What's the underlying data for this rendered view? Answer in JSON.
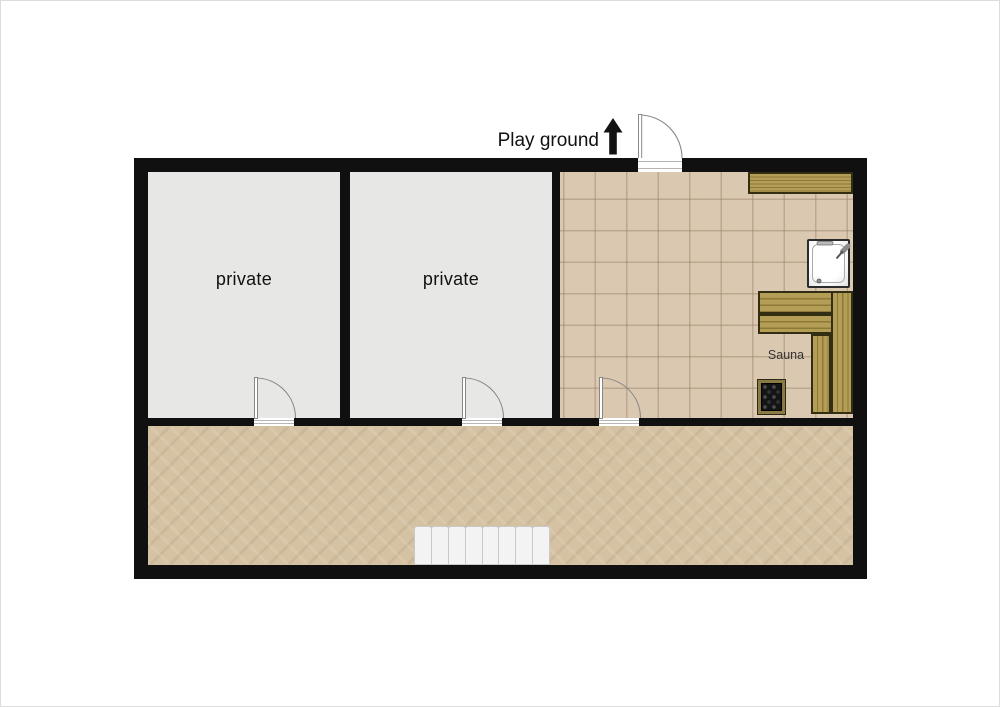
{
  "page": {
    "background": "#ffffff"
  },
  "labels": {
    "playground": "Play ground",
    "private_room_1": "private",
    "private_room_2": "private",
    "sauna": "Sauna"
  },
  "colors": {
    "page_bg": "#ffffff",
    "wall": "#101010",
    "private_floor": "#e7e7e5",
    "tile_floor": "#dbc8b1",
    "tile_grout": "#b49e83",
    "corridor_floor": "#d5c2a3",
    "wood": "#b49d55",
    "wood_dark": "#8d7a38",
    "bench_border": "#332d13",
    "stair_fill": "#f3f3f3",
    "stair_edge": "#c9c9c9",
    "door_line": "#8a8a8a",
    "threshold_line": "#b5b5b5",
    "shower_border": "#2b2b2b",
    "heater_frame": "#8a7b45",
    "heater_body": "#151515",
    "text": "#111111"
  },
  "icons": {
    "up_arrow": "direction-up-arrow",
    "door": "door-swing",
    "shower": "shower-tray",
    "heater": "sauna-heater",
    "stairs": "staircase",
    "bench": "sauna-bench"
  }
}
